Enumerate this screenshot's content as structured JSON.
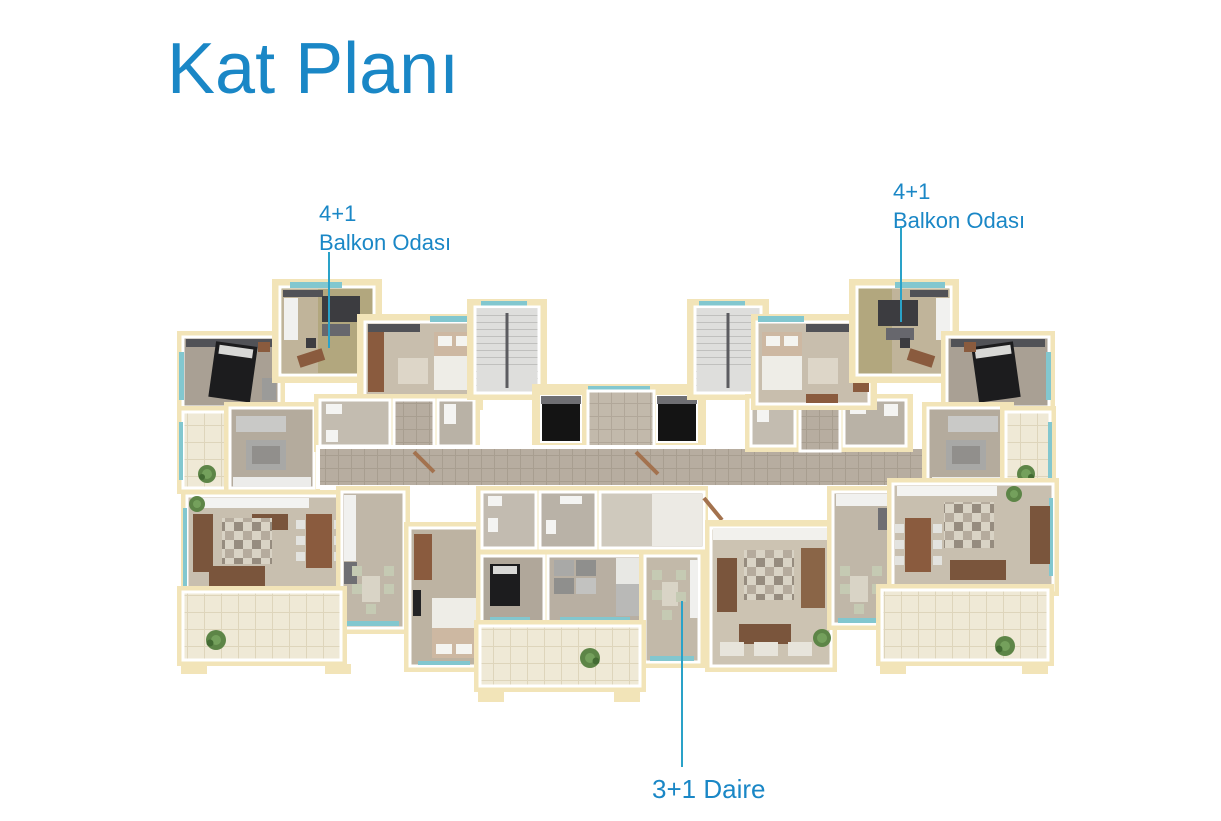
{
  "title": {
    "text": "Kat Planı"
  },
  "annotations": {
    "left_unit": {
      "type_label": "4+1",
      "room_label": "Balkon Odası"
    },
    "right_unit": {
      "type_label": "4+1",
      "room_label": "Balkon Odası"
    },
    "bottom_unit": {
      "label": "3+1 Daire"
    }
  },
  "colors": {
    "background": "#ffffff",
    "accent": "#1a87c6",
    "leader-line": "#2aa2c8",
    "cream-wall": "#f2e4b8",
    "teal-glass": "#82c7cf",
    "corridor-tile": "#b7ada0",
    "corridor-grout": "#a89e90",
    "lobby-tile": "#c2b9ab",
    "lobby-grout": "#b1a799",
    "balcony-tile": "#efe9d6",
    "balcony-grout": "#ded5bb"
  }
}
